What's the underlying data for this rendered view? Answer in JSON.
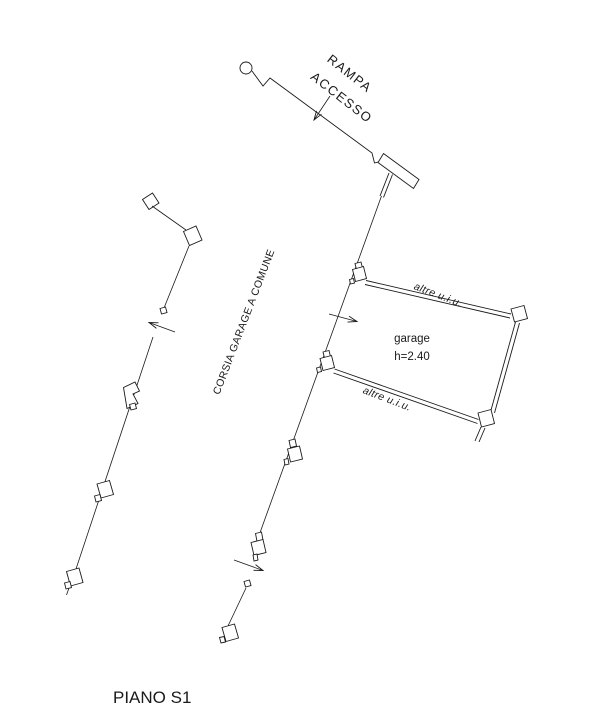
{
  "drawing": {
    "title": "PIANO S1",
    "ramp_label_line1": "RAMPA",
    "ramp_label_line2": "ACCESSO",
    "corridor_label": "CORSIA GARAGE A COMUNE",
    "garage_label": "garage",
    "garage_height_label": "h=2.40",
    "adjacent_unit_label_top": "altre u.i.u.",
    "adjacent_unit_label_bottom": "altre u.i.u.",
    "colors": {
      "ink": "#1a1a1a",
      "background": "#ffffff"
    }
  }
}
